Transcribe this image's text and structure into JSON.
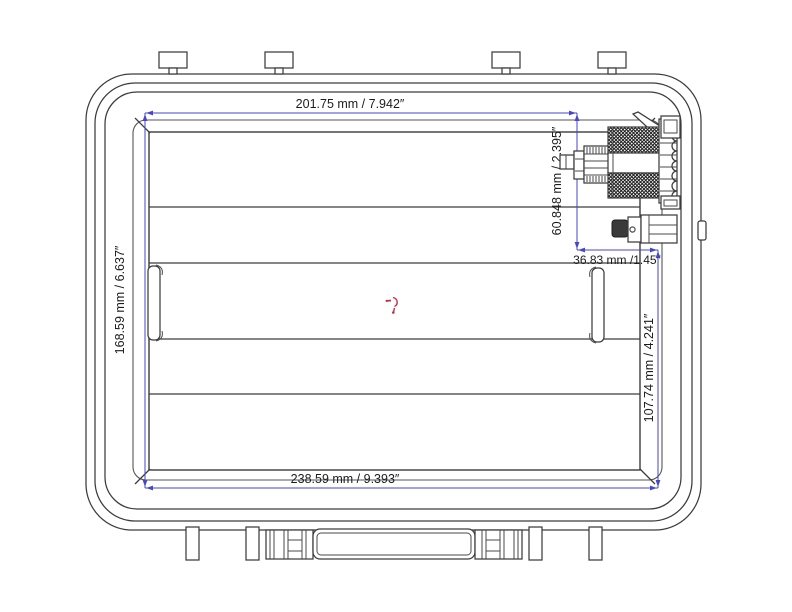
{
  "drawing": {
    "type": "case-interior-technical-drawing",
    "dimensions": {
      "top": {
        "label": "201.75 mm / 7.942″"
      },
      "left": {
        "label": "168.59 mm / 6.637″"
      },
      "bottom": {
        "label": "238.59 mm / 9.393″"
      },
      "tool_height": {
        "label": "60.848 mm / 2.395″"
      },
      "tool_width": {
        "label": "36.83 mm /1.45″"
      },
      "right": {
        "label": "107.74 mm / 4.241″"
      }
    },
    "colors": {
      "dimension_line": "#4646c8",
      "drawing_line": "#3c3c3c",
      "center_marker": "#c92a4a",
      "background": "#ffffff"
    }
  }
}
